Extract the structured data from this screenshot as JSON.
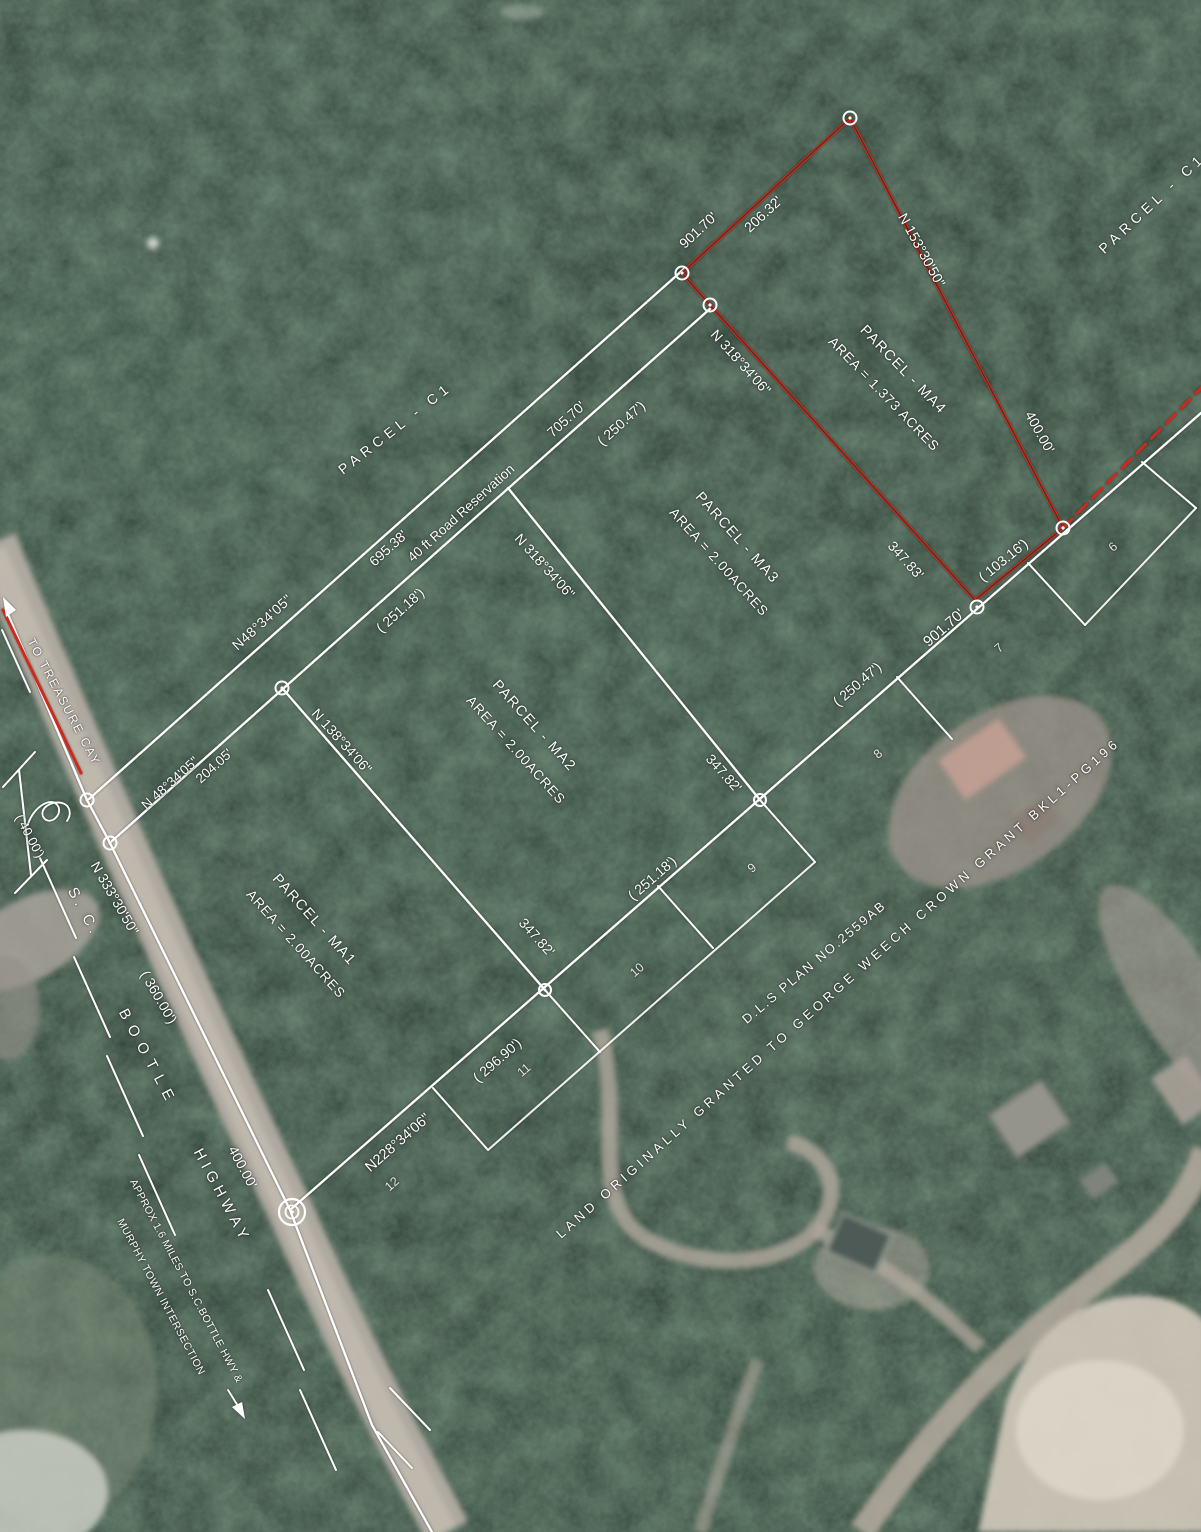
{
  "colors": {
    "survey_line": "#ffffff",
    "parcel_ma4_outline": "#cc2b1e",
    "label_text": "#ffffff"
  },
  "labels": [
    {
      "name": "to-treasure-cay-label",
      "text": "TO TREASURE CAY",
      "x": 64,
      "y": 702,
      "rot": 62,
      "fs": 12,
      "ls": 2
    },
    {
      "name": "bearing-n48-upper",
      "text": "N48°34'05\"",
      "x": 262,
      "y": 622,
      "rot": -42,
      "fs": 14,
      "ls": 0.5
    },
    {
      "name": "dist-695-38",
      "text": "695.38'",
      "x": 388,
      "y": 548,
      "rot": -42,
      "fs": 14
    },
    {
      "name": "road-reservation-label",
      "text": "40 ft Road Reservation",
      "x": 461,
      "y": 513,
      "rot": -42,
      "fs": 13.5
    },
    {
      "name": "dist-705-70",
      "text": "705.70'",
      "x": 566,
      "y": 419,
      "rot": -42,
      "fs": 14
    },
    {
      "name": "dist-250-47-a",
      "text": "( 250.47')",
      "x": 621,
      "y": 423,
      "rot": -42,
      "fs": 14
    },
    {
      "name": "parcel-c1-left-label",
      "text": "PARCEL - C1",
      "x": 395,
      "y": 428,
      "rot": -38,
      "fs": 14,
      "ls": 5
    },
    {
      "name": "parcel-c1-right-label",
      "text": "PARCEL - C1",
      "x": 1152,
      "y": 203,
      "rot": -43,
      "fs": 14,
      "ls": 5
    },
    {
      "name": "bearing-n48-lower",
      "text": "N 48°34'05\"",
      "x": 170,
      "y": 783,
      "rot": -42,
      "fs": 13.5
    },
    {
      "name": "dist-204-05",
      "text": "204.05'",
      "x": 214,
      "y": 766,
      "rot": -42,
      "fs": 13.5
    },
    {
      "name": "bearing-n318-ma2",
      "text": "N 318°34'06\"",
      "x": 545,
      "y": 566,
      "rot": 48,
      "fs": 14
    },
    {
      "name": "dist-251-18-a",
      "text": "( 251.18')",
      "x": 400,
      "y": 610,
      "rot": -42,
      "fs": 14
    },
    {
      "name": "bearing-n138-ma1",
      "text": "N 138°34'06\"",
      "x": 342,
      "y": 741,
      "rot": 48,
      "fs": 14
    },
    {
      "name": "parcel-ma1-label",
      "text": "PARCEL - MA1",
      "x": 314,
      "y": 920,
      "rot": 48,
      "fs": 14.5,
      "ls": 1.5
    },
    {
      "name": "parcel-ma1-area",
      "text": "AREA = 2.00ACRES",
      "x": 296,
      "y": 944,
      "rot": 48,
      "fs": 13.5,
      "ls": 1
    },
    {
      "name": "parcel-ma2-label",
      "text": "PARCEL - MA2",
      "x": 534,
      "y": 726,
      "rot": 48,
      "fs": 14.5,
      "ls": 1.5
    },
    {
      "name": "parcel-ma2-area",
      "text": "AREA = 2.00ACRES",
      "x": 516,
      "y": 750,
      "rot": 48,
      "fs": 13.5,
      "ls": 1
    },
    {
      "name": "parcel-ma3-label",
      "text": "PARCEL - MA3",
      "x": 737,
      "y": 538,
      "rot": 48,
      "fs": 14.5,
      "ls": 1.5
    },
    {
      "name": "parcel-ma3-area",
      "text": "AREA = 2.00ACRES",
      "x": 719,
      "y": 562,
      "rot": 48,
      "fs": 13.5,
      "ls": 1
    },
    {
      "name": "parcel-ma4-label",
      "text": "PARCEL - MA4",
      "x": 903,
      "y": 370,
      "rot": 46,
      "fs": 14.5,
      "ls": 1.5
    },
    {
      "name": "parcel-ma4-area",
      "text": "AREA = 1.373 ACRES",
      "x": 884,
      "y": 394,
      "rot": 46,
      "fs": 13.5,
      "ls": 1
    },
    {
      "name": "dist-206-32",
      "text": "206.32'",
      "x": 763,
      "y": 214,
      "rot": -43,
      "fs": 14
    },
    {
      "name": "dist-901-70-top",
      "text": "901.70'",
      "x": 698,
      "y": 230,
      "rot": -43,
      "fs": 14
    },
    {
      "name": "bearing-n153",
      "text": "N 153°30'50\"",
      "x": 922,
      "y": 250,
      "rot": 61,
      "fs": 14
    },
    {
      "name": "dist-400-00-red",
      "text": "400.00'",
      "x": 1040,
      "y": 432,
      "rot": 61,
      "fs": 14
    },
    {
      "name": "bearing-n318-red",
      "text": "N 318°34'06\"",
      "x": 741,
      "y": 362,
      "rot": 48,
      "fs": 14
    },
    {
      "name": "dist-347-83",
      "text": "347.83'",
      "x": 906,
      "y": 560,
      "rot": 48,
      "fs": 14
    },
    {
      "name": "dist-103-16",
      "text": "( 103.16')",
      "x": 1003,
      "y": 560,
      "rot": -39,
      "fs": 14
    },
    {
      "name": "dist-901-70-mid",
      "text": "901.70'",
      "x": 944,
      "y": 628,
      "rot": -41,
      "fs": 15
    },
    {
      "name": "dist-250-47-b",
      "text": "( 250.47')",
      "x": 857,
      "y": 684,
      "rot": -41,
      "fs": 14
    },
    {
      "name": "dist-347-82-a",
      "text": "347.82'",
      "x": 724,
      "y": 773,
      "rot": 48,
      "fs": 14
    },
    {
      "name": "dist-251-18-b",
      "text": "( 251.18')",
      "x": 652,
      "y": 878,
      "rot": -41,
      "fs": 14
    },
    {
      "name": "dist-347-82-b",
      "text": "347.82'",
      "x": 537,
      "y": 937,
      "rot": 48,
      "fs": 14
    },
    {
      "name": "dist-296-90",
      "text": "( 296.90')",
      "x": 497,
      "y": 1060,
      "rot": -41,
      "fs": 14
    },
    {
      "name": "bearing-n228",
      "text": "N228°34'06\"",
      "x": 398,
      "y": 1143,
      "rot": -41,
      "fs": 14.5
    },
    {
      "name": "lot-6-label",
      "text": "6",
      "x": 1113,
      "y": 547,
      "rot": -41,
      "fs": 12.5,
      "cls": "dim"
    },
    {
      "name": "lot-7-label",
      "text": "7",
      "x": 999,
      "y": 648,
      "rot": -41,
      "fs": 12.5,
      "cls": "dim"
    },
    {
      "name": "lot-8-label",
      "text": "8",
      "x": 878,
      "y": 754,
      "rot": -41,
      "fs": 12.5,
      "cls": "dim"
    },
    {
      "name": "lot-9-label",
      "text": "9",
      "x": 752,
      "y": 868,
      "rot": -41,
      "fs": 12.5,
      "cls": "dim"
    },
    {
      "name": "lot-10-label",
      "text": "10",
      "x": 637,
      "y": 970,
      "rot": -41,
      "fs": 12.5,
      "cls": "dim"
    },
    {
      "name": "lot-11-label",
      "text": "11",
      "x": 524,
      "y": 1070,
      "rot": -41,
      "fs": 12.5,
      "cls": "dim"
    },
    {
      "name": "lot-12-label",
      "text": "12",
      "x": 392,
      "y": 1184,
      "rot": -41,
      "fs": 12.5,
      "cls": "dim"
    },
    {
      "name": "dls-plan-label",
      "text": "D.L.S PLAN NO.2559AB",
      "x": 814,
      "y": 962,
      "rot": -40,
      "fs": 13,
      "ls": 2
    },
    {
      "name": "land-grant-label",
      "text": "LAND ORIGINALLY GRANTED TO GEORGE WEECH CROWN GRANT BKL1-PG196",
      "x": 838,
      "y": 988,
      "rot": -41.5,
      "fs": 13,
      "ls": 4
    },
    {
      "name": "bearing-n333",
      "text": "N 333°30'50\"",
      "x": 115,
      "y": 898,
      "rot": 60,
      "fs": 14
    },
    {
      "name": "dist-360-00",
      "text": "( 360.00')",
      "x": 159,
      "y": 997,
      "rot": 60,
      "fs": 14
    },
    {
      "name": "dist-40-00",
      "text": "( 40.00')",
      "x": 30,
      "y": 836,
      "rot": 62,
      "fs": 13
    },
    {
      "name": "highway-name-sc",
      "text": "S. C.",
      "x": 84,
      "y": 912,
      "rot": 62,
      "fs": 15,
      "ls": 4
    },
    {
      "name": "highway-name-bootle",
      "text": "BOOTLE",
      "x": 148,
      "y": 1058,
      "rot": 62,
      "fs": 15,
      "ls": 8
    },
    {
      "name": "highway-name-highway",
      "text": "HIGHWAY",
      "x": 222,
      "y": 1196,
      "rot": 62,
      "fs": 15,
      "ls": 5
    },
    {
      "name": "dist-400-00-hwy",
      "text": "400.00'",
      "x": 243,
      "y": 1167,
      "rot": 62,
      "fs": 14
    },
    {
      "name": "approx-note-line1",
      "text": "APPROX 1.6 MILES TO S.C.BOTTLE HWY &",
      "x": 186,
      "y": 1281,
      "rot": 62,
      "fs": 10.5,
      "ls": 0.4
    },
    {
      "name": "approx-note-line2",
      "text": "MURPHY TOWN INTERSECTION",
      "x": 161,
      "y": 1297,
      "rot": 62,
      "fs": 10.5,
      "ls": 0.6
    }
  ]
}
